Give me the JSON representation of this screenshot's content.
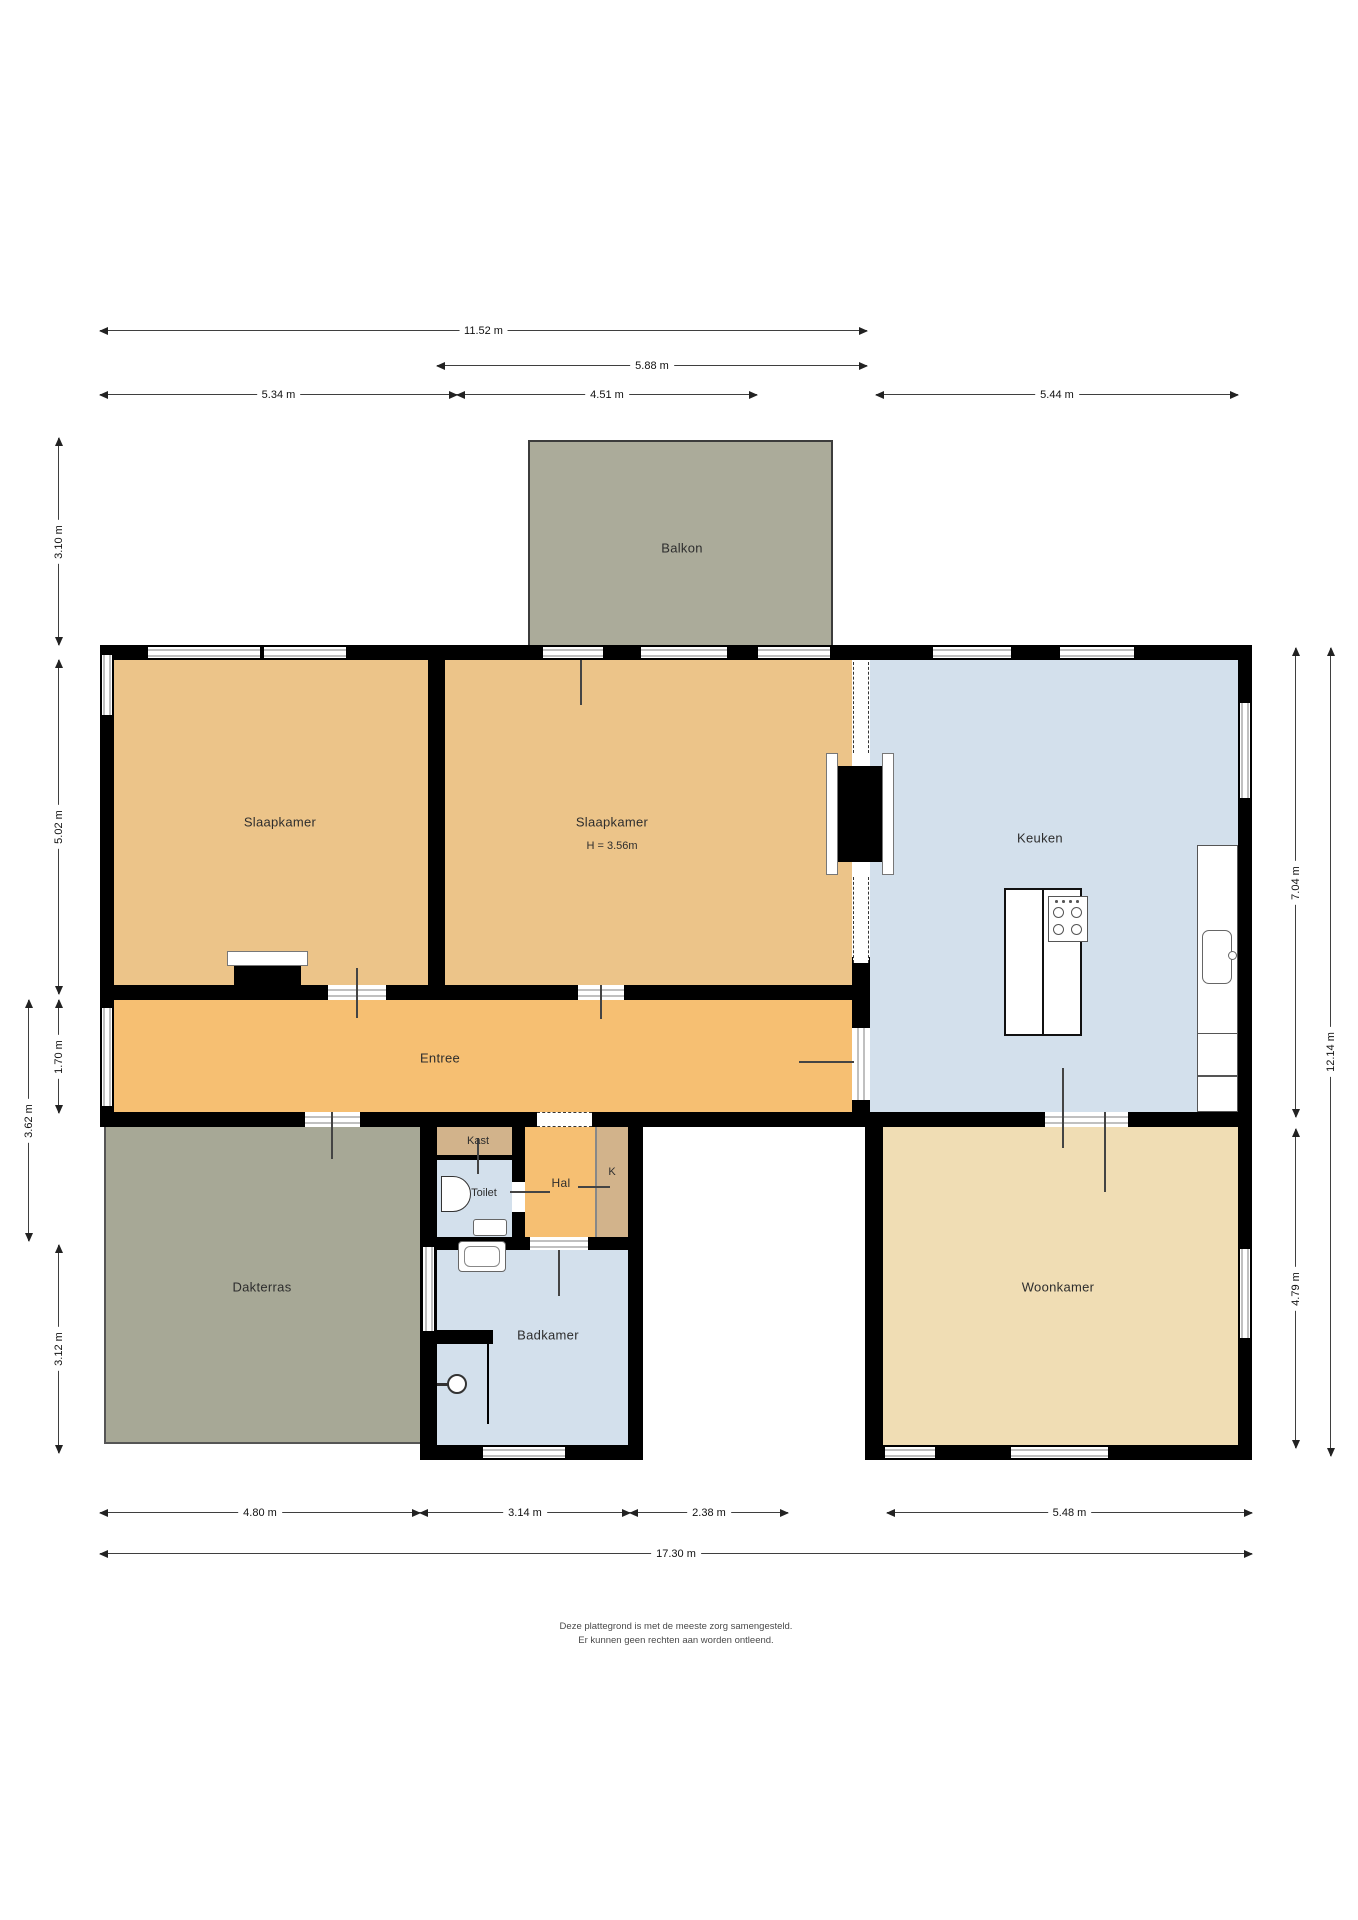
{
  "rooms": {
    "balkon": {
      "label": "Balkon"
    },
    "slaapkamer1": {
      "label": "Slaapkamer"
    },
    "slaapkamer2": {
      "label": "Slaapkamer",
      "height_note": "H = 3.56m"
    },
    "keuken": {
      "label": "Keuken"
    },
    "entree": {
      "label": "Entree"
    },
    "kast": {
      "label": "Kast"
    },
    "toilet": {
      "label": "Toilet"
    },
    "hal": {
      "label": "Hal"
    },
    "k_closet": {
      "label": "K"
    },
    "dakterras": {
      "label": "Dakterras"
    },
    "badkamer": {
      "label": "Badkamer"
    },
    "woonkamer": {
      "label": "Woonkamer"
    }
  },
  "dimensions": {
    "t_total": "11.52 m",
    "t_br2": "5.88 m",
    "t_br1": "5.34 m",
    "t_br2_inner": "4.51 m",
    "t_keuken": "5.44 m",
    "l_balkon": "3.10 m",
    "l_slaapkamer": "5.02 m",
    "l_entree": "1.70 m",
    "l_entree_zone": "3.62 m",
    "l_dakterras": "3.12 m",
    "r_keuken": "7.04 m",
    "r_woonkamer": "4.79 m",
    "r_total": "12.14 m",
    "b_dakterras": "4.80 m",
    "b_badkamer": "3.14 m",
    "b_tussen": "2.38 m",
    "b_woonkamer": "5.48 m",
    "b_total": "17.30 m"
  },
  "footer": {
    "line1": "Deze plattegrond is met de meeste zorg samengesteld.",
    "line2": "Er kunnen geen rechten aan worden ontleend."
  },
  "colors": {
    "bedroom": "#ecc489",
    "entree_hal": "#f6bf72",
    "kitchen_bath": "#d3e0ec",
    "woonkamer": "#f0ddb4",
    "terrace": "#a7a896",
    "balcony": "#abab9a",
    "closet": "#d2b38b",
    "wall": "#000000"
  }
}
